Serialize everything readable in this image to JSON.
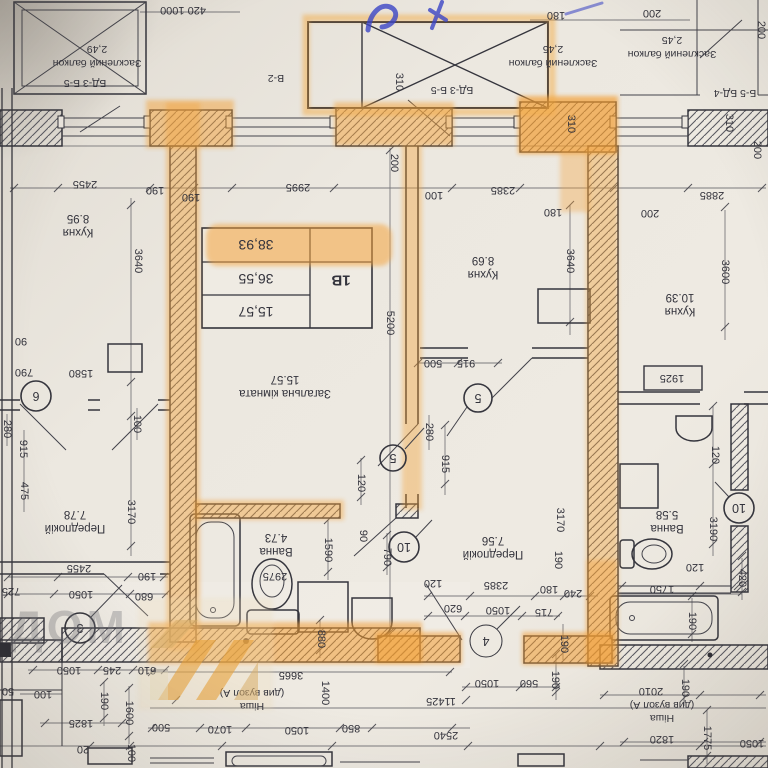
{
  "palette": {
    "highlighter": "#f3a33c",
    "highlighter_strong": "#f29c30",
    "ink": "#33333c",
    "pen_blue": "#3b45c6",
    "paper": "#ece8e0"
  },
  "unit_summary": {
    "unit": "1B",
    "living_area": "15,57",
    "area_without_balcony": "36,55",
    "total_area": "38,93"
  },
  "rooms": {
    "living": {
      "name": "Загальна кімната",
      "area": "15.57"
    },
    "kitchen_1b": {
      "name": "Кухня",
      "area": "8.69"
    },
    "bath_1b": {
      "name": "Ванна",
      "area": "4.73"
    },
    "hall_1b": {
      "name": "Передпокій",
      "area": "7.56"
    },
    "kitchen_left": {
      "name": "Кухня",
      "area": "8.95"
    },
    "hall_left": {
      "name": "Передпокій",
      "area": "7.78"
    },
    "kitchen_right": {
      "name": "Кухня",
      "area": "10.39"
    },
    "bath_right": {
      "name": "Ванна",
      "area": "5.58"
    }
  },
  "balconies": {
    "left": {
      "name": "Засклений балкон",
      "area": "2,49"
    },
    "mid": {
      "name": "Засклений балкон",
      "area": "2,45"
    },
    "right": {
      "name": "Засклений балкон",
      "area": "2,45"
    }
  },
  "joinery_tags": {
    "left": "БД-3 Б-5",
    "window": "В-2",
    "mid": "БД-3 Б-5",
    "right": "Б-5 БД-4"
  },
  "axis_bubbles": {
    "b3": "3",
    "b4": "4",
    "b5a": "5",
    "b5b": "5",
    "b6": "6",
    "b10a": "10",
    "b10b": "10"
  },
  "annotations": {
    "niche_left_title": "Ніша",
    "niche_left_note": "(див вузол А)",
    "niche_right_title": "Ніша",
    "niche_right_note": "(див вузол А)",
    "watermark": "ДОМ"
  },
  "dims": [
    "420 1000",
    "180",
    "200",
    "200",
    "310",
    "310",
    "310",
    "200",
    "2455",
    "190",
    "190",
    "2995",
    "100",
    "2385",
    "180",
    "200",
    "2885",
    "200",
    "3640",
    "5200",
    "3640",
    "3600",
    "90",
    "790",
    "1580",
    "100",
    "3170",
    "280",
    "915",
    "475",
    "500",
    "915",
    "280",
    "915",
    "120",
    "1925",
    "120",
    "3190",
    "3170",
    "2455",
    "190",
    "725",
    "1050",
    "680",
    "2975",
    "1590",
    "90",
    "790",
    "190",
    "120",
    "2385",
    "180",
    "240",
    "620",
    "1050",
    "715",
    "120",
    "1750",
    "190",
    "880",
    "190",
    "610",
    "1050",
    "245",
    "100",
    "50",
    "190",
    "1600",
    "1825",
    "20",
    "100",
    "3665",
    "1400",
    "11425",
    "1050",
    "560",
    "190",
    "500",
    "1070",
    "1050",
    "850",
    "2540",
    "2010",
    "190",
    "1775",
    "1820",
    "1050",
    "420"
  ]
}
